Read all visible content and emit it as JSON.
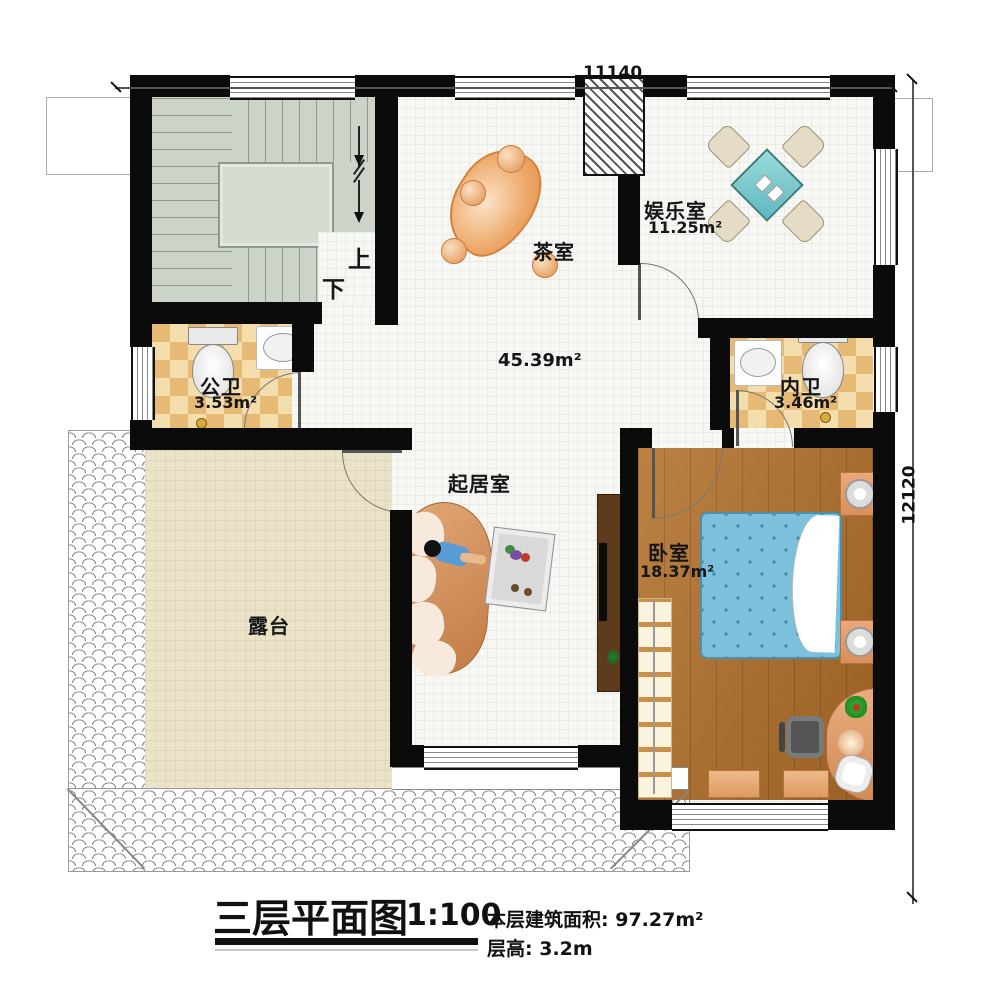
{
  "plan": {
    "dimensions": {
      "width_mm": "11140",
      "height_mm": "12120"
    },
    "stairs": {
      "up": "上",
      "down": "下"
    },
    "rooms": {
      "tea": {
        "name": "茶室"
      },
      "entertainment": {
        "name": "娱乐室",
        "area": "11.25m²"
      },
      "public_bath": {
        "name": "公卫",
        "area": "3.53m²"
      },
      "inner_bath": {
        "name": "内卫",
        "area": "3.46m²"
      },
      "hall": {
        "area": "45.39m²"
      },
      "living": {
        "name": "起居室"
      },
      "terrace": {
        "name": "露台"
      },
      "bedroom": {
        "name": "卧室",
        "area": "18.37m²"
      }
    }
  },
  "titleblock": {
    "title": "三层平面图",
    "scale": "1:100",
    "floor_area_label": "本层建筑面积:",
    "floor_area_value": "97.27m²",
    "floor_height_label": "层高:",
    "floor_height_value": "3.2m"
  },
  "watermark": {
    "text": "柏竣建筑"
  },
  "colors": {
    "wall": "#0b0b0b",
    "wood_floor": "#b26f29",
    "bed": "#7cc0dc",
    "bath_tile": "#e6ba74",
    "stair_floor": "#ccd3c9",
    "terrace_floor": "#eae3c8",
    "sofa": "#d69868"
  }
}
